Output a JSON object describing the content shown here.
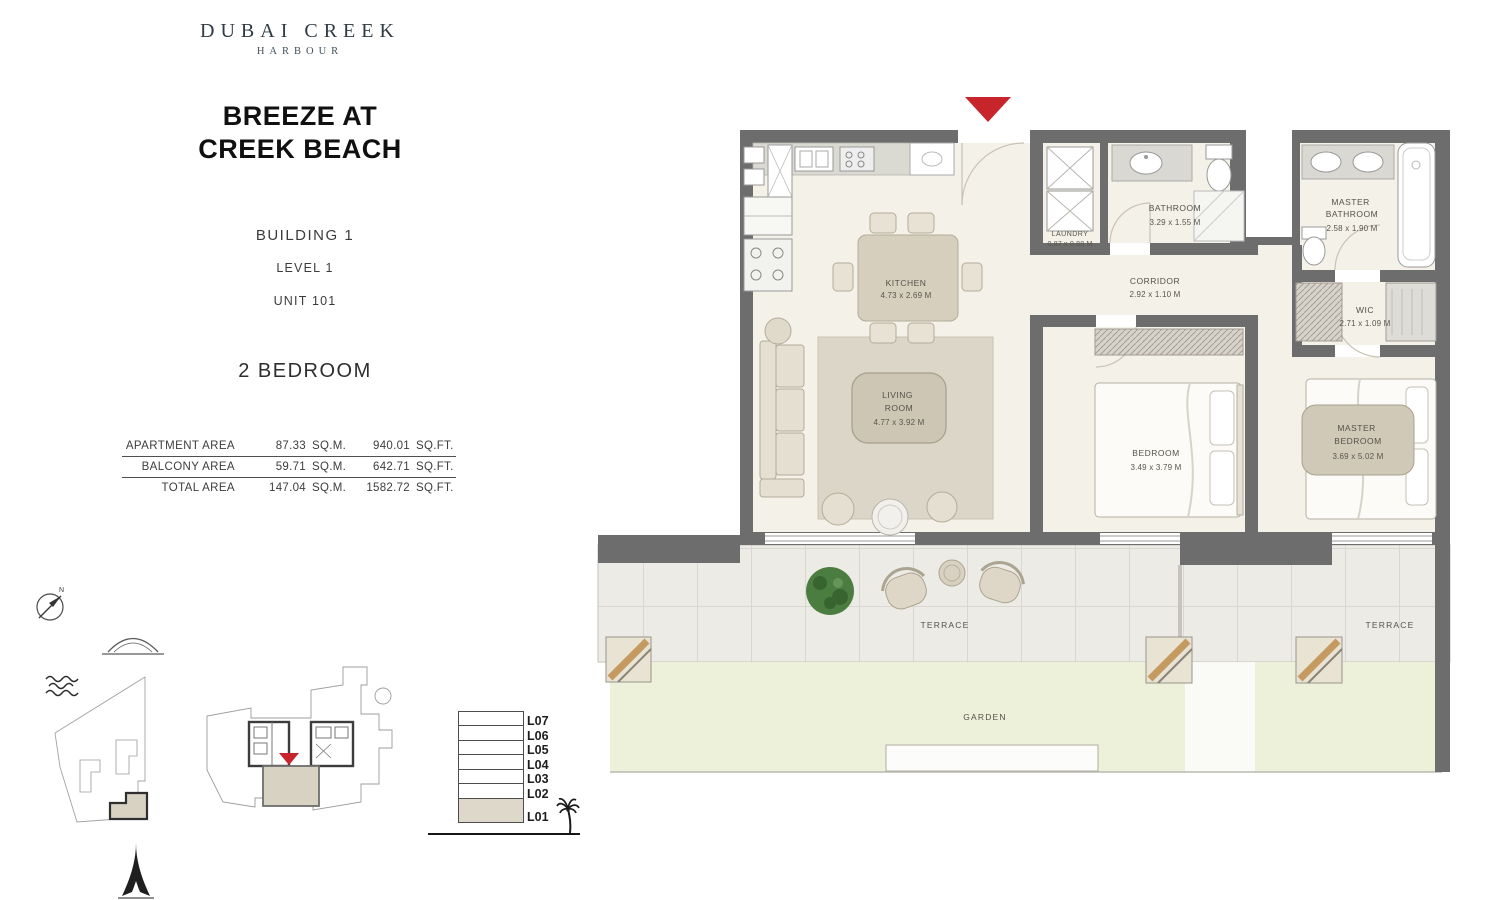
{
  "brand": {
    "name": "DUBAI CREEK",
    "sub": "HARBOUR"
  },
  "project": {
    "title_line1": "BREEZE AT",
    "title_line2": "CREEK BEACH"
  },
  "unit": {
    "building": "BUILDING 1",
    "level": "LEVEL 1",
    "unit": "UNIT 101",
    "type": "2 BEDROOM"
  },
  "areas": {
    "apartment": {
      "label": "APARTMENT AREA",
      "sqm": "87.33",
      "sqm_unit": "SQ.M.",
      "sqft": "940.01",
      "sqft_unit": "SQ.FT."
    },
    "balcony": {
      "label": "BALCONY AREA",
      "sqm": "59.71",
      "sqm_unit": "SQ.M.",
      "sqft": "642.71",
      "sqft_unit": "SQ.FT."
    },
    "total": {
      "label": "TOTAL AREA",
      "sqm": "147.04",
      "sqm_unit": "SQ.M.",
      "sqft": "1582.72",
      "sqft_unit": "SQ.FT."
    }
  },
  "rooms": {
    "kitchen": {
      "name": "KITCHEN",
      "dims": "4.73 x 2.69 M"
    },
    "living": {
      "name_line1": "LIVING",
      "name_line2": "ROOM",
      "dims": "4.77 x 3.92 M"
    },
    "laundry": {
      "name": "LAUNDRY",
      "dims": "0.87 x 0.88 M"
    },
    "bathroom": {
      "name": "BATHROOM",
      "dims": "3.29 x 1.55 M"
    },
    "corridor": {
      "name": "CORRIDOR",
      "dims": "2.92 x 1.10 M"
    },
    "master_bathroom": {
      "name_line1": "MASTER",
      "name_line2": "BATHROOM",
      "dims": "2.58 x 1.90 M"
    },
    "wic": {
      "name": "WIC",
      "dims": "2.71 x 1.09 M"
    },
    "bedroom": {
      "name": "BEDROOM",
      "dims": "3.49 x 3.79 M"
    },
    "master_bedroom": {
      "name_line1": "MASTER",
      "name_line2": "BEDROOM",
      "dims": "3.69 x 5.02 M"
    }
  },
  "outdoor": {
    "terrace_left": "TERRACE",
    "terrace_right": "TERRACE",
    "garden": "GARDEN"
  },
  "levels": {
    "items": [
      "L07",
      "L06",
      "L05",
      "L04",
      "L03",
      "L02",
      "L01"
    ],
    "highlighted": "L01"
  },
  "compass": {
    "label": "N"
  },
  "colors": {
    "wall": "#6d6d6d",
    "accent_red": "#c8242b",
    "garden": "#edf1d9",
    "terrace": "#ecebe5",
    "floor": "#f4f1e8",
    "highlight": "#d8d2c3"
  }
}
